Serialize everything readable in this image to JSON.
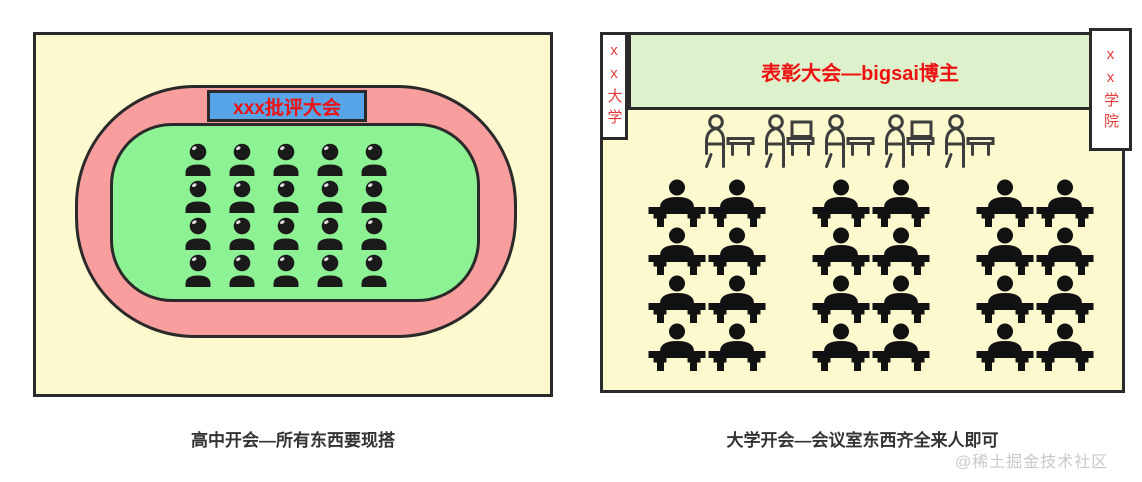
{
  "left_figure": {
    "banner": "xxx批评大会",
    "caption": "高中开会—所有东西要现搭",
    "audience": {
      "rows": 4,
      "cols": 5,
      "count": 20
    }
  },
  "right_figure": {
    "banner": "表彰大会—bigsai博主",
    "left_sign": "xx大学",
    "right_sign": "xx学院",
    "caption": "大学开会—会议室东西齐全来人即可",
    "podium_row": {
      "count": 5
    },
    "seating": {
      "groups": 3,
      "cols_per_group": 2,
      "rows": 4,
      "seats_per_group": 8
    }
  },
  "watermark": "@稀土掘金技术社区",
  "icons": {
    "audience_icon": "person-silhouette-icon",
    "seat_icon": "person-at-desk-icon",
    "podium_icon": "speaker-at-lectern-outline-icon"
  },
  "colors": {
    "panel_background": "#fbf9cd",
    "track": "#f89e9e",
    "infield": "#8df293",
    "left_banner_background": "#58a4e9",
    "right_banner_background": "#ddf2cc",
    "banner_text": "#ee1111",
    "sign_text": "#e23b3b",
    "outline_border": "#2a2a2a",
    "caption_text": "#333333",
    "watermark_text": "#c9c9c9"
  }
}
